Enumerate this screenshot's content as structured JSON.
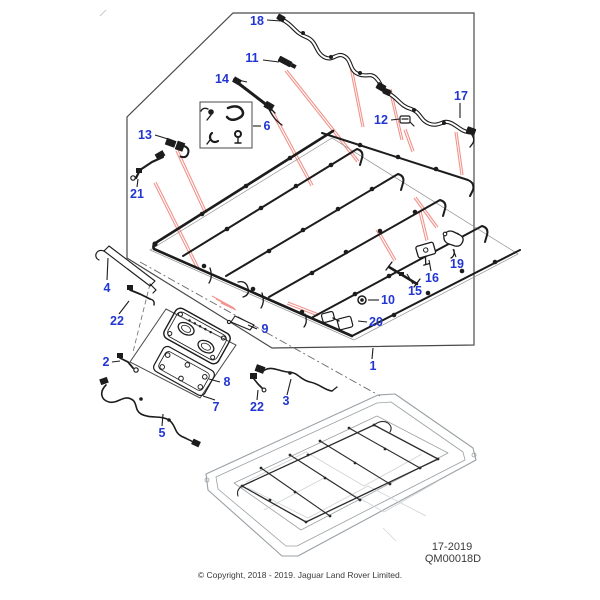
{
  "diagram": {
    "plate_code": "17-2019",
    "drawing_number": "QM00018D",
    "copyright_notice": "© Copyright, 2018 - 2019. Jaguar Land Rover Limited."
  },
  "colors": {
    "callout_blue": "#2236d2",
    "leader_red": "#f2938c",
    "linework_black": "#1c1c1c"
  },
  "callouts": [
    {
      "n": "18",
      "x": 257,
      "y": 21
    },
    {
      "n": "11",
      "x": 252,
      "y": 58
    },
    {
      "n": "14",
      "x": 222,
      "y": 79
    },
    {
      "n": "6",
      "x": 267,
      "y": 126
    },
    {
      "n": "12",
      "x": 381,
      "y": 120
    },
    {
      "n": "17",
      "x": 461,
      "y": 96
    },
    {
      "n": "13",
      "x": 145,
      "y": 135
    },
    {
      "n": "21",
      "x": 137,
      "y": 194
    },
    {
      "n": "4",
      "x": 107,
      "y": 288
    },
    {
      "n": "22",
      "x": 117,
      "y": 321
    },
    {
      "n": "2",
      "x": 106,
      "y": 362
    },
    {
      "n": "5",
      "x": 162,
      "y": 433
    },
    {
      "n": "8",
      "x": 227,
      "y": 382
    },
    {
      "n": "7",
      "x": 216,
      "y": 407
    },
    {
      "n": "22",
      "x": 257,
      "y": 407
    },
    {
      "n": "3",
      "x": 286,
      "y": 401
    },
    {
      "n": "9",
      "x": 265,
      "y": 329
    },
    {
      "n": "10",
      "x": 388,
      "y": 300
    },
    {
      "n": "20",
      "x": 376,
      "y": 322
    },
    {
      "n": "15",
      "x": 415,
      "y": 291
    },
    {
      "n": "16",
      "x": 432,
      "y": 278
    },
    {
      "n": "19",
      "x": 457,
      "y": 264
    },
    {
      "n": "1",
      "x": 373,
      "y": 366
    }
  ]
}
